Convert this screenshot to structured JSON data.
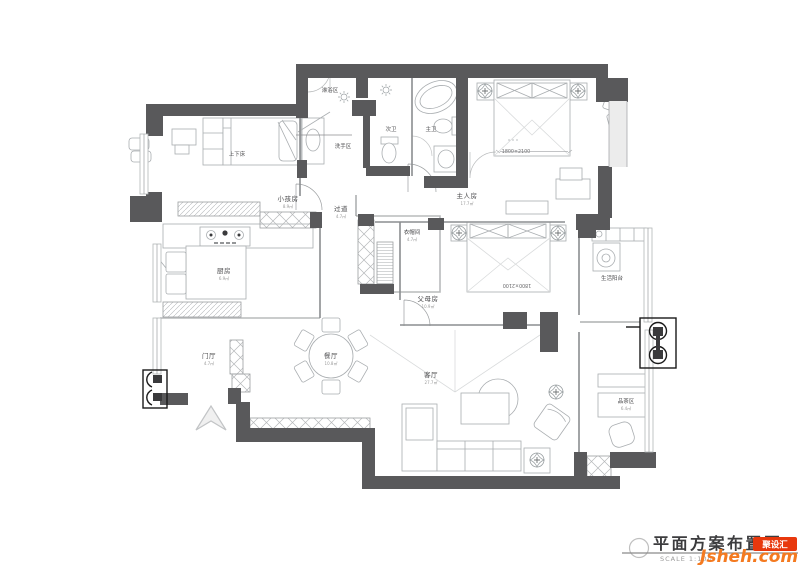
{
  "drawing": {
    "type": "residential floor plan",
    "rooms": [
      {
        "name": "淋浴区",
        "area": ""
      },
      {
        "name": "洗手区",
        "area": ""
      },
      {
        "name": "次卫",
        "area": ""
      },
      {
        "name": "主卫",
        "area": ""
      },
      {
        "name": "上下床",
        "area": ""
      },
      {
        "name": "小孩房",
        "area": "8.9㎡"
      },
      {
        "name": "过道",
        "area": "4.7㎡"
      },
      {
        "name": "主人房",
        "area": "17.7㎡"
      },
      {
        "name": "衣帽间",
        "area": "4.7㎡"
      },
      {
        "name": "厨房",
        "area": "6.9㎡"
      },
      {
        "name": "生活阳台",
        "area": ""
      },
      {
        "name": "父母房",
        "area": "10.9㎡"
      },
      {
        "name": "门厅",
        "area": "4.7㎡"
      },
      {
        "name": "餐厅",
        "area": "10.8㎡"
      },
      {
        "name": "客厅",
        "area": "27.7㎡"
      },
      {
        "name": "品茶区",
        "area": "6.4㎡"
      }
    ],
    "dimensions": {
      "master_bed": "1800×2100",
      "parents_bed": "1800×2100"
    }
  },
  "title_block": {
    "title": "平面方案布置图",
    "scale": "SCALE 1:100"
  },
  "watermark": {
    "brand": "Jsheh.com",
    "badge": "聚设汇"
  },
  "colors": {
    "wall": "#59595b",
    "logo_orange": "#f47a20",
    "badge_red": "#e8380d"
  }
}
